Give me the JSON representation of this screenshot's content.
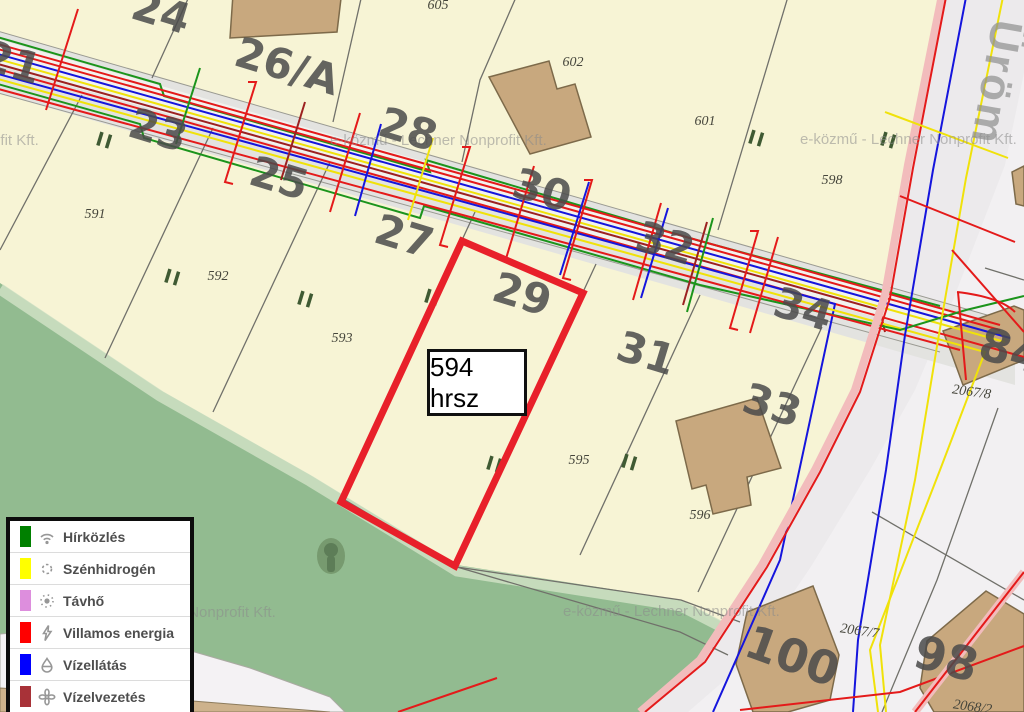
{
  "map": {
    "watermark": "e-közmű - Lechner Nonprofit Kft.",
    "street_label": "Üröm",
    "highlight": {
      "label": "594 hrsz",
      "outline_color": "#e8202a"
    },
    "house_numbers": [
      "21",
      "24",
      "23",
      "25",
      "26/A",
      "27",
      "28",
      "29",
      "30",
      "31",
      "32",
      "33",
      "34",
      "84",
      "100",
      "98"
    ],
    "parcel_numbers": [
      "591",
      "592",
      "593",
      "595",
      "596",
      "605",
      "602",
      "601",
      "598",
      "2067/8",
      "2067/7",
      "2068/2"
    ]
  },
  "legend": {
    "items": [
      {
        "label": "Hírközlés",
        "color": "#008000",
        "icon": "wifi-icon"
      },
      {
        "label": "Szénhidrogén",
        "color": "#ffff00",
        "icon": "gas-sun-icon"
      },
      {
        "label": "Távhő",
        "color": "#dd8edd",
        "icon": "sun-icon"
      },
      {
        "label": "Villamos energia",
        "color": "#ff0000",
        "icon": "lightning-icon"
      },
      {
        "label": "Vízellátás",
        "color": "#0000ff",
        "icon": "water-drop-icon"
      },
      {
        "label": "Vízelvezetés",
        "color": "#a83238",
        "icon": "fan-icon"
      }
    ]
  },
  "colors": {
    "parcel_fill": "#f7f4d5",
    "vegetation_fill": "#92bb90",
    "outside_zone_fill": "#f2f0f2",
    "road_fill": "#e3e3e0",
    "building_fill": "#c8a87e",
    "highlight_red": "#e8202a"
  }
}
